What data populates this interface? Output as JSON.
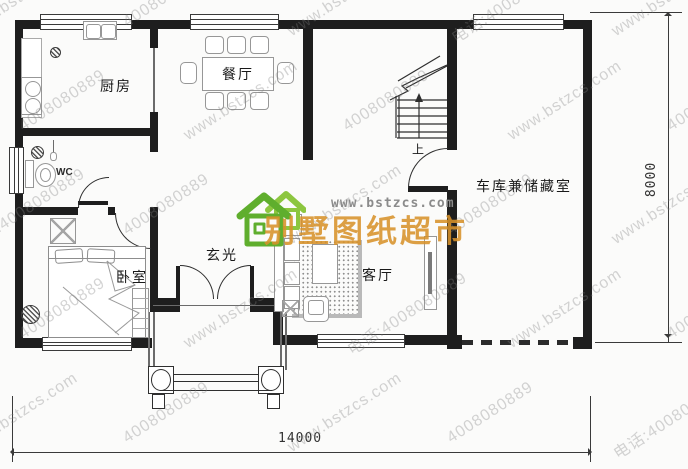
{
  "plan": {
    "labels": {
      "kitchen": "厨房",
      "dining": "餐厅",
      "wc": "WC",
      "bedroom": "卧室",
      "foyer": "玄光",
      "living": "客厅",
      "garage": "车库兼储藏室",
      "stairs_up": "上"
    },
    "dimensions": {
      "width": "14000",
      "height": "8000"
    }
  },
  "branding": {
    "logo_text": "别墅图纸超市",
    "site_url": "www.bstzcs.com",
    "colors": {
      "logo_green": "#5fae2d",
      "logo_green_light": "#8cc63f",
      "logo_orange": "#d7922a"
    }
  },
  "watermark": {
    "lines": [
      "www.bstzcs.com",
      "4008080889",
      "电话:4008080889"
    ]
  }
}
